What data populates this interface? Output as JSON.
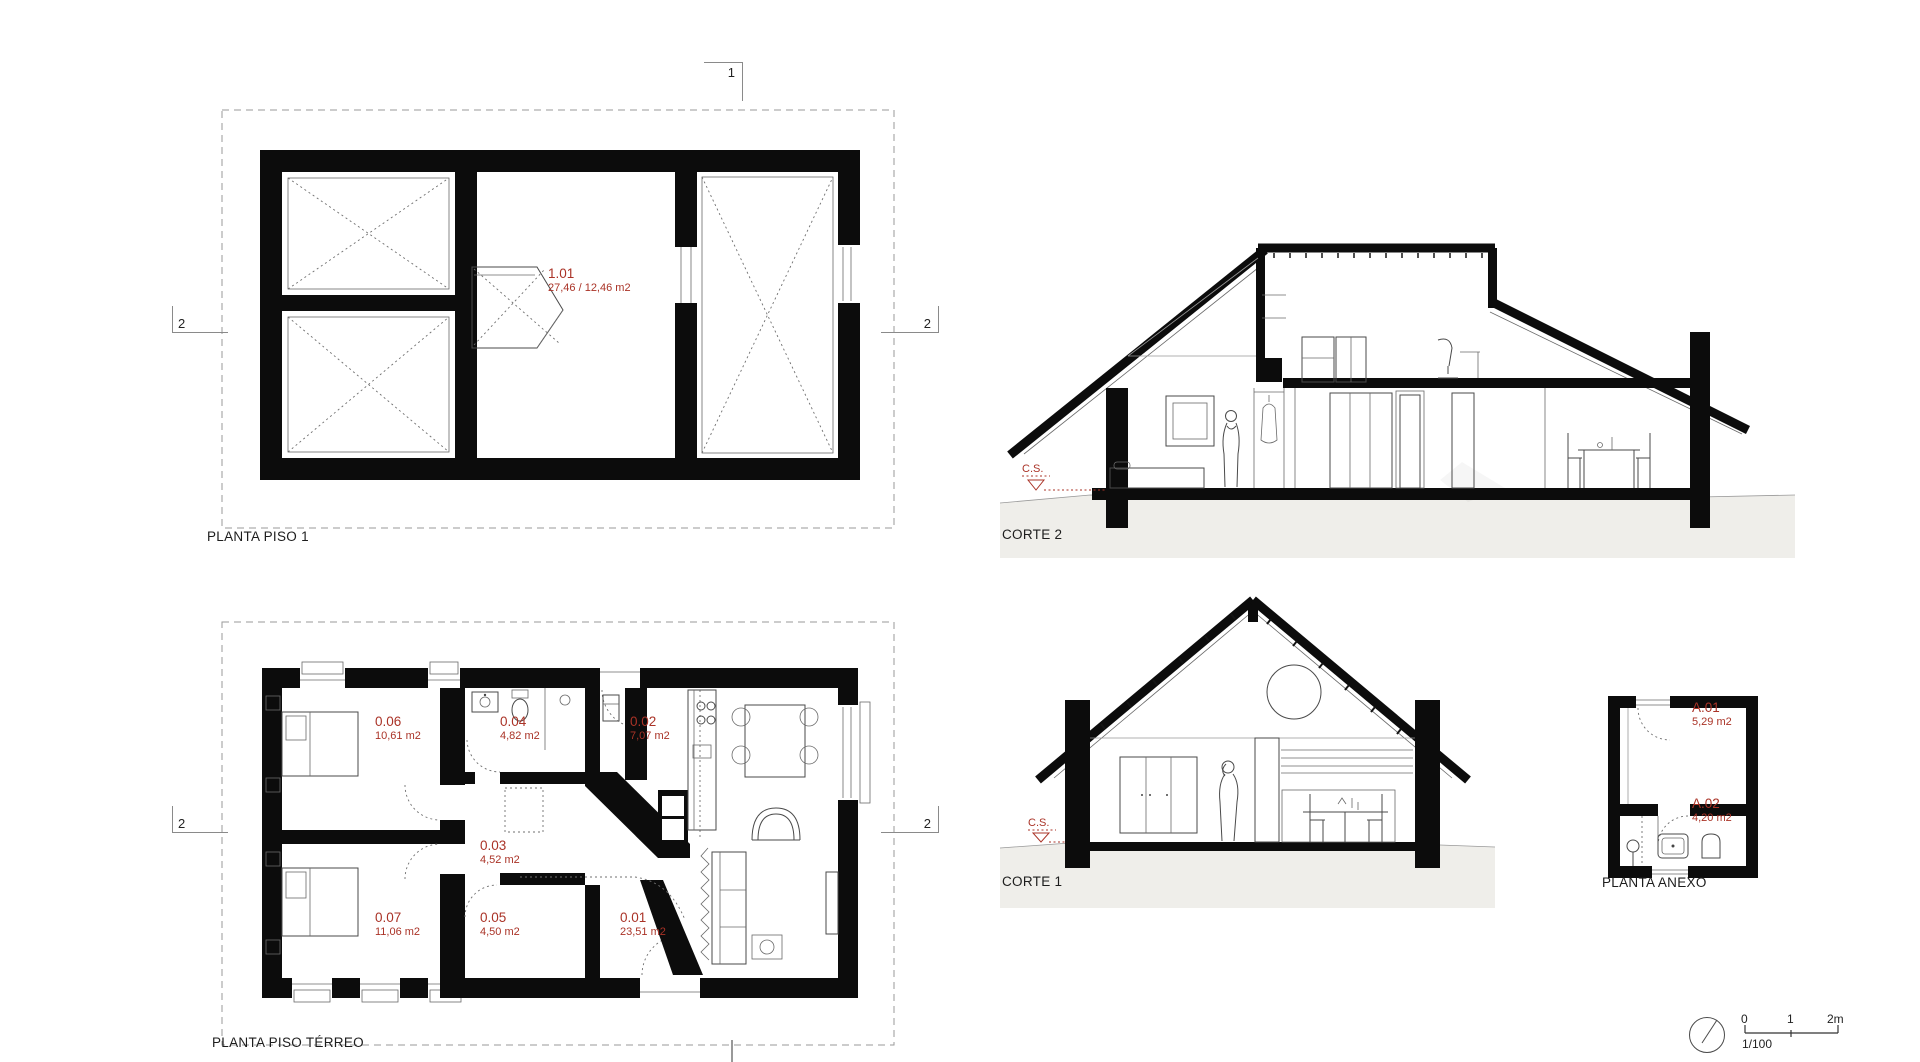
{
  "colors": {
    "accent_red": "#aa3327",
    "ground_gray": "#efeeea",
    "ink": "#1c1c1c"
  },
  "piso1": {
    "title": "PLANTA PISO 1",
    "room_id": "1.01",
    "room_area": "27,46 / 12,46 m2"
  },
  "terreo": {
    "title": "PLANTA PISO TÉRREO",
    "rooms": [
      {
        "id": "0.06",
        "area": "10,61 m2"
      },
      {
        "id": "0.04",
        "area": "4,82 m2"
      },
      {
        "id": "0.02",
        "area": "7,07 m2"
      },
      {
        "id": "0.03",
        "area": "4,52 m2"
      },
      {
        "id": "0.07",
        "area": "11,06 m2"
      },
      {
        "id": "0.05",
        "area": "4,50 m2"
      },
      {
        "id": "0.01",
        "area": "23,51 m2"
      }
    ]
  },
  "anexo": {
    "title": "PLANTA ANEXO",
    "rooms": [
      {
        "id": "A.01",
        "area": "5,29 m2"
      },
      {
        "id": "A.02",
        "area": "4,20 m2"
      }
    ]
  },
  "corte2": {
    "title": "CORTE 2",
    "level_marker": "C.S."
  },
  "corte1": {
    "title": "CORTE 1",
    "level_marker": "C.S."
  },
  "markers": {
    "section_one": "1",
    "section_two": "2"
  },
  "scalebar": {
    "tick_0": "0",
    "tick_1": "1",
    "tick_2": "2m",
    "ratio": "1/100"
  }
}
